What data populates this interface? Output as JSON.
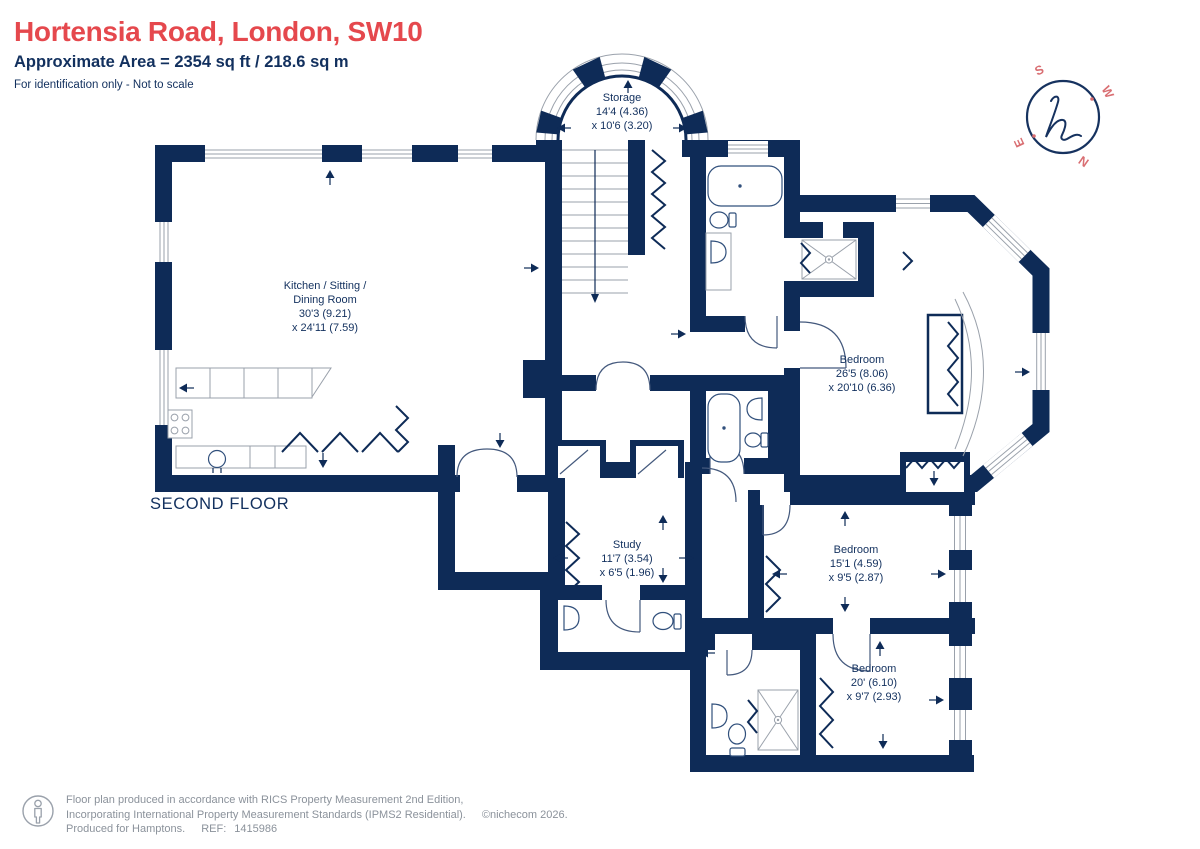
{
  "header": {
    "title": "Hortensia Road, London, SW10",
    "area_line": "Approximate Area = 2354 sq ft / 218.6 sq m",
    "disclaimer": "For identification only - Not to scale"
  },
  "floor_label": "SECOND FLOOR",
  "compass": {
    "n": "N",
    "s": "S",
    "e": "E",
    "w": "W",
    "monogram": "h"
  },
  "rooms": [
    {
      "id": "storage",
      "name": "Storage",
      "dim1": "14'4 (4.36)",
      "dim2": "x 10'6 (3.20)"
    },
    {
      "id": "kitchen",
      "name": "Kitchen / Sitting /",
      "name2": "Dining Room",
      "dim1": "30'3 (9.21)",
      "dim2": "x 24'11 (7.59)"
    },
    {
      "id": "bedroom-1",
      "name": "Bedroom",
      "dim1": "26'5 (8.06)",
      "dim2": "x 20'10 (6.36)"
    },
    {
      "id": "study",
      "name": "Study",
      "dim1": "11'7 (3.54)",
      "dim2": "x 6'5 (1.96)"
    },
    {
      "id": "bedroom-2",
      "name": "Bedroom",
      "dim1": "15'1 (4.59)",
      "dim2": "x 9'5 (2.87)"
    },
    {
      "id": "bedroom-3",
      "name": "Bedroom",
      "dim1": "20' (6.10)",
      "dim2": "x 9'7 (2.93)"
    }
  ],
  "footer": {
    "line1": "Floor plan produced in accordance with RICS Property Measurement 2nd Edition,",
    "line2": "Incorporating International Property Measurement Standards (IPMS2 Residential).",
    "copyright": "©nichecom 2026.",
    "line3_prefix": "Produced for Hamptons.",
    "ref_label": "REF:",
    "ref_value": "1415986"
  },
  "colors": {
    "wall_navy": "#0e2b57",
    "title_red": "#e5484d",
    "compass_red": "#d96e72",
    "footer_gray": "#8b929b"
  }
}
